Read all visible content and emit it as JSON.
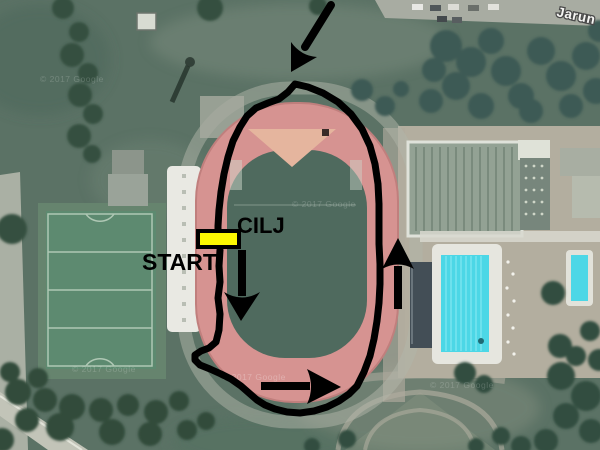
{
  "map": {
    "place_label": "Jarun",
    "watermark": "© 2017 Google",
    "colors": {
      "route": "#000000",
      "marker_fill": "#fcf802",
      "marker_border": "#000000",
      "track": "#d69391",
      "track_edge": "#c07f7d",
      "infield": "#4f6a5e",
      "d_zone": "#e5b59e",
      "pool_water": "#4cd7e6",
      "grass": "#5b7265"
    }
  },
  "course": {
    "start_label": "START",
    "finish_label": "CILJ",
    "loop_path": "M220,250 L219,266 220,282 218,298 220,314 219,330 216,342 209,348 201,351 195,355 195,360 200,365 210,369 221,374 231,379 241,386 249,393 257,400 265,405 275,409 287,412 300,413 314,411 327,407 339,401 349,394 357,386 364,372 370,356 374,339 377,321 379,303 380,284 380,264 379,244 379,224 379,204 378,184 375,164 370,146 362,129 351,114 338,102 323,93 308,87 295,84 288,92 279,99 268,103 256,108 247,116 240,127 233,141 228,157 224,174 221,192 219,210 218,226 218,231",
    "marker": {
      "x": 198,
      "y": 231,
      "width": 41,
      "height": 16
    }
  },
  "arrows": {
    "entry": {
      "shaft": "M331,5 L305,47",
      "head": "M317,57 Q301,56 291,42 L291,72 Z"
    },
    "down": {
      "shaft": "M242,250 L242,296",
      "head": "M224,292 Q242,303 260,292 L241,321 Z"
    },
    "right": {
      "shaft": "M261,386 L310,386",
      "head": "M307,369 Q315,387 307,404 L341,387 Z"
    },
    "up": {
      "shaft": "M398,309 L398,266",
      "head": "M382,269 Q398,260 414,269 L398,238 Z"
    }
  }
}
